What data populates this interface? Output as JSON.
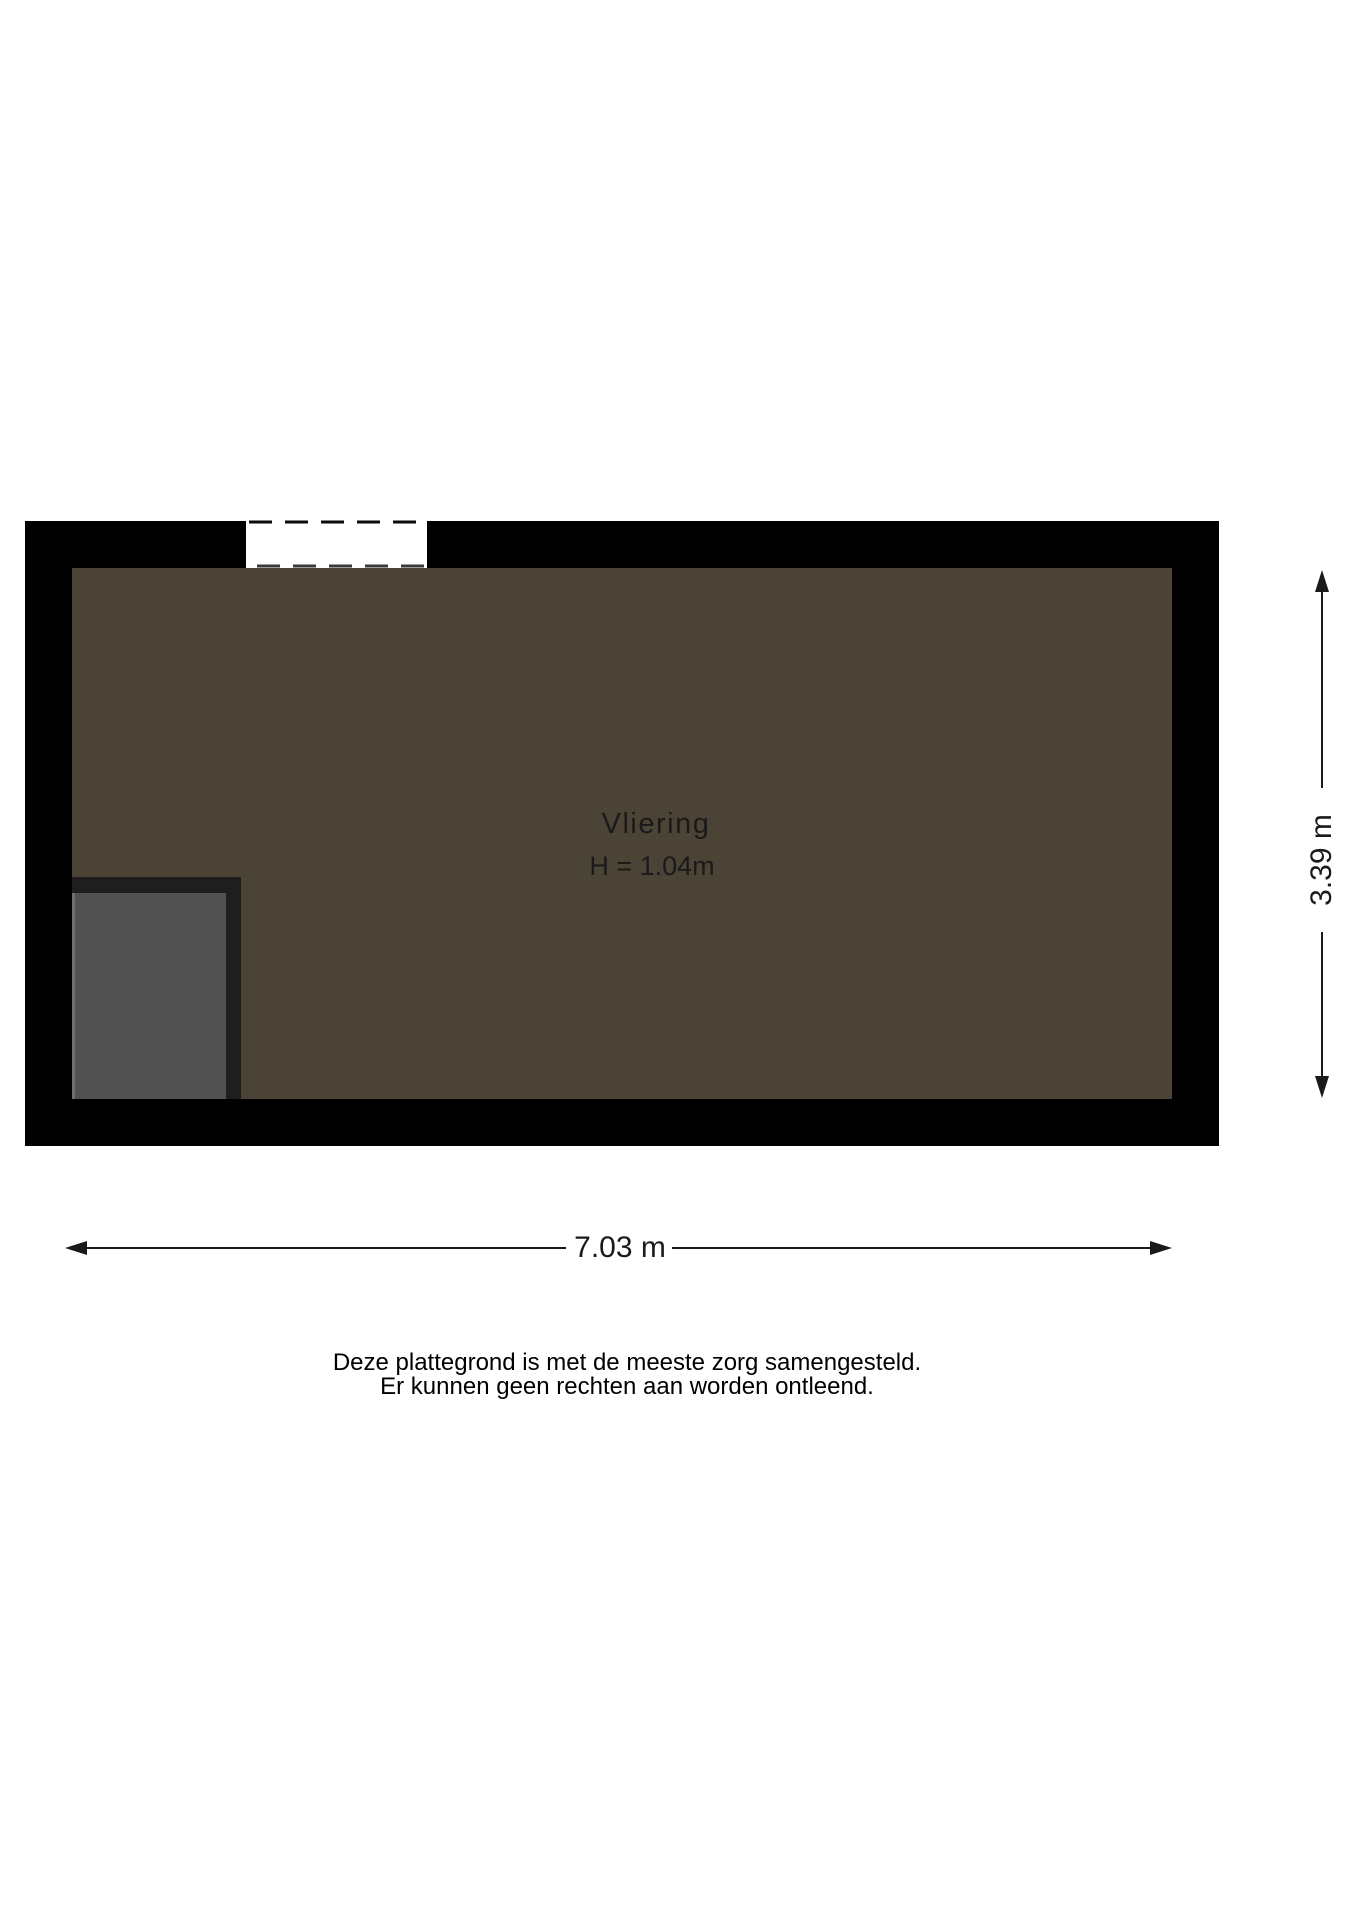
{
  "floorplan": {
    "room": {
      "name": "Vliering",
      "height_label": "H = 1.04m"
    },
    "dimensions": {
      "width_label": "7.03 m",
      "height_label": "3.39 m"
    },
    "colors": {
      "wall": "#000000",
      "floor": "#4b4335",
      "hatch_frame": "#1e1e1e",
      "hatch_fill": "#515151",
      "hatch_edge_highlight": "#6f6f6f",
      "opening_fill": "#ffffff",
      "opening_dash_top": "#0a0a0a",
      "opening_dash_bottom": "#3a3a3a",
      "dimension_line": "#1a1a1a",
      "text": "#1a1a1a"
    }
  },
  "disclaimer": {
    "line1": "Deze plattegrond is met de meeste zorg samengesteld.",
    "line2": "Er kunnen geen rechten aan worden ontleend."
  }
}
